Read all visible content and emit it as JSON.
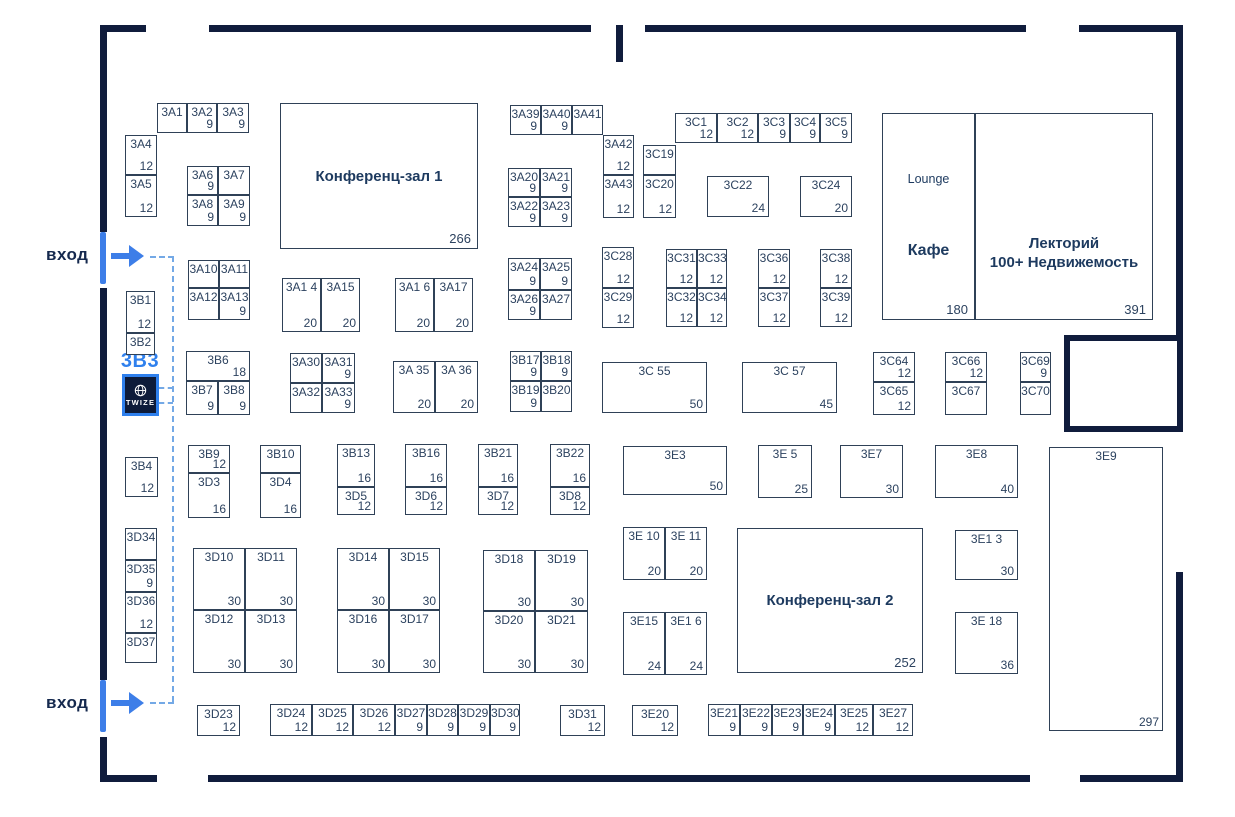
{
  "colors": {
    "wall": "#101c3c",
    "line": "#2f4157",
    "text": "#2c425f",
    "heading": "#1d3a5f",
    "accent": "#2f80ed",
    "route": "#74a9e6",
    "twize_bg": "#0d1b3a"
  },
  "entrances": {
    "top": "вход",
    "bottom": "вход"
  },
  "twize": {
    "booth_id": "3B3",
    "brand": "TWIZE"
  },
  "halls": [
    {
      "label": "Конференц-зал 1",
      "area": "266"
    },
    {
      "label": "Конференц-зал 2",
      "area": "252"
    }
  ],
  "lounge": {
    "zone_label": "Lounge",
    "cafe_label": "Кафе",
    "area": "180"
  },
  "lectory": {
    "line1": "Лекторий",
    "line2": "100+ Недвижемость",
    "area": "391"
  },
  "booths": [
    {
      "id": "3A1",
      "area": "",
      "x": 157,
      "y": 103,
      "w": 30,
      "h": 30
    },
    {
      "id": "3A2",
      "area": "9",
      "x": 187,
      "y": 103,
      "w": 30,
      "h": 30
    },
    {
      "id": "3A3",
      "area": "9",
      "x": 217,
      "y": 103,
      "w": 32,
      "h": 30
    },
    {
      "id": "3A4",
      "area": "12",
      "x": 125,
      "y": 135,
      "w": 32,
      "h": 40
    },
    {
      "id": "3A5",
      "area": "12",
      "x": 125,
      "y": 175,
      "w": 32,
      "h": 42
    },
    {
      "id": "3A6",
      "area": "9",
      "x": 187,
      "y": 166,
      "w": 31,
      "h": 29
    },
    {
      "id": "3A7",
      "area": "",
      "x": 218,
      "y": 166,
      "w": 32,
      "h": 29
    },
    {
      "id": "3A8",
      "area": "9",
      "x": 187,
      "y": 195,
      "w": 31,
      "h": 31
    },
    {
      "id": "3A9",
      "area": "9",
      "x": 218,
      "y": 195,
      "w": 32,
      "h": 31
    },
    {
      "id": "3A10",
      "area": "",
      "x": 188,
      "y": 260,
      "w": 31,
      "h": 28
    },
    {
      "id": "3A11",
      "area": "",
      "x": 219,
      "y": 260,
      "w": 31,
      "h": 28
    },
    {
      "id": "3A12",
      "area": "",
      "x": 188,
      "y": 288,
      "w": 31,
      "h": 32
    },
    {
      "id": "3A13",
      "area": "9",
      "x": 219,
      "y": 288,
      "w": 31,
      "h": 32
    },
    {
      "id": "3A14",
      "label": "3A1 4",
      "area": "20",
      "x": 282,
      "y": 278,
      "w": 39,
      "h": 54
    },
    {
      "id": "3A15",
      "area": "20",
      "x": 321,
      "y": 278,
      "w": 39,
      "h": 54
    },
    {
      "id": "3A16",
      "label": "3A1 6",
      "area": "20",
      "x": 395,
      "y": 278,
      "w": 39,
      "h": 54
    },
    {
      "id": "3A17",
      "area": "20",
      "x": 434,
      "y": 278,
      "w": 39,
      "h": 54
    },
    {
      "id": "3B1",
      "area": "12",
      "x": 126,
      "y": 291,
      "w": 29,
      "h": 42
    },
    {
      "id": "3B2",
      "area": "",
      "x": 126,
      "y": 333,
      "w": 29,
      "h": 22
    },
    {
      "id": "3B4",
      "area": "12",
      "x": 125,
      "y": 457,
      "w": 33,
      "h": 40
    },
    {
      "id": "3B6",
      "area": "18",
      "x": 186,
      "y": 351,
      "w": 64,
      "h": 30
    },
    {
      "id": "3B7",
      "area": "9",
      "x": 186,
      "y": 381,
      "w": 32,
      "h": 34
    },
    {
      "id": "3B8",
      "area": "9",
      "x": 218,
      "y": 381,
      "w": 32,
      "h": 34
    },
    {
      "id": "3A30",
      "area": "",
      "x": 290,
      "y": 353,
      "w": 32,
      "h": 30
    },
    {
      "id": "3A31",
      "area": "9",
      "x": 322,
      "y": 353,
      "w": 33,
      "h": 30
    },
    {
      "id": "3A32",
      "area": "",
      "x": 290,
      "y": 383,
      "w": 32,
      "h": 30
    },
    {
      "id": "3A33",
      "area": "9",
      "x": 322,
      "y": 383,
      "w": 33,
      "h": 30
    },
    {
      "id": "3A35",
      "label": "3A 35",
      "area": "20",
      "x": 393,
      "y": 361,
      "w": 42,
      "h": 52
    },
    {
      "id": "3A36",
      "label": "3A 36",
      "area": "20",
      "x": 435,
      "y": 361,
      "w": 43,
      "h": 52
    },
    {
      "id": "3B17",
      "area": "9",
      "x": 510,
      "y": 351,
      "w": 31,
      "h": 30
    },
    {
      "id": "3B18",
      "area": "9",
      "x": 541,
      "y": 351,
      "w": 31,
      "h": 30
    },
    {
      "id": "3B19",
      "area": "9",
      "x": 510,
      "y": 381,
      "w": 31,
      "h": 31
    },
    {
      "id": "3B20",
      "area": "",
      "x": 541,
      "y": 381,
      "w": 31,
      "h": 31
    },
    {
      "id": "3A39",
      "area": "9",
      "x": 510,
      "y": 105,
      "w": 31,
      "h": 30
    },
    {
      "id": "3A40",
      "area": "9",
      "x": 541,
      "y": 105,
      "w": 31,
      "h": 30
    },
    {
      "id": "3A41",
      "area": "",
      "x": 572,
      "y": 105,
      "w": 31,
      "h": 30
    },
    {
      "id": "3A42",
      "area": "12",
      "x": 603,
      "y": 135,
      "w": 31,
      "h": 40
    },
    {
      "id": "3A43",
      "area": "12",
      "x": 603,
      "y": 175,
      "w": 31,
      "h": 43
    },
    {
      "id": "3C19",
      "area": "",
      "x": 643,
      "y": 145,
      "w": 33,
      "h": 30
    },
    {
      "id": "3C20",
      "area": "12",
      "x": 643,
      "y": 175,
      "w": 33,
      "h": 43
    },
    {
      "id": "3C1",
      "area": "12",
      "x": 675,
      "y": 113,
      "w": 42,
      "h": 30
    },
    {
      "id": "3C2",
      "area": "12",
      "x": 717,
      "y": 113,
      "w": 41,
      "h": 30
    },
    {
      "id": "3C3",
      "area": "9",
      "x": 758,
      "y": 113,
      "w": 32,
      "h": 30
    },
    {
      "id": "3C4",
      "area": "9",
      "x": 790,
      "y": 113,
      "w": 30,
      "h": 30
    },
    {
      "id": "3C5",
      "area": "9",
      "x": 820,
      "y": 113,
      "w": 32,
      "h": 30
    },
    {
      "id": "3C22",
      "area": "24",
      "x": 707,
      "y": 176,
      "w": 62,
      "h": 41
    },
    {
      "id": "3C24",
      "area": "20",
      "x": 800,
      "y": 176,
      "w": 52,
      "h": 41
    },
    {
      "id": "3A20",
      "area": "9",
      "x": 508,
      "y": 168,
      "w": 32,
      "h": 29
    },
    {
      "id": "3A21",
      "area": "9",
      "x": 540,
      "y": 168,
      "w": 32,
      "h": 29
    },
    {
      "id": "3A22",
      "area": "9",
      "x": 508,
      "y": 197,
      "w": 32,
      "h": 30
    },
    {
      "id": "3A23",
      "area": "9",
      "x": 540,
      "y": 197,
      "w": 32,
      "h": 30
    },
    {
      "id": "3A24",
      "area": "9",
      "x": 508,
      "y": 258,
      "w": 32,
      "h": 32
    },
    {
      "id": "3A25",
      "area": "9",
      "x": 540,
      "y": 258,
      "w": 32,
      "h": 32
    },
    {
      "id": "3A26",
      "area": "9",
      "x": 508,
      "y": 290,
      "w": 32,
      "h": 30
    },
    {
      "id": "3A27",
      "area": "",
      "x": 540,
      "y": 290,
      "w": 32,
      "h": 30
    },
    {
      "id": "3C28",
      "area": "12",
      "x": 602,
      "y": 247,
      "w": 32,
      "h": 41
    },
    {
      "id": "3C29",
      "area": "12",
      "x": 602,
      "y": 288,
      "w": 32,
      "h": 40
    },
    {
      "id": "3C31",
      "area": "12",
      "x": 666,
      "y": 249,
      "w": 31,
      "h": 39
    },
    {
      "id": "3C33",
      "area": "12",
      "x": 697,
      "y": 249,
      "w": 30,
      "h": 39
    },
    {
      "id": "3C32",
      "area": "12",
      "x": 666,
      "y": 288,
      "w": 31,
      "h": 39
    },
    {
      "id": "3C34",
      "area": "12",
      "x": 697,
      "y": 288,
      "w": 30,
      "h": 39
    },
    {
      "id": "3C36",
      "area": "12",
      "x": 758,
      "y": 249,
      "w": 32,
      "h": 39
    },
    {
      "id": "3C37",
      "area": "12",
      "x": 758,
      "y": 288,
      "w": 32,
      "h": 39
    },
    {
      "id": "3C38",
      "area": "12",
      "x": 820,
      "y": 249,
      "w": 32,
      "h": 39
    },
    {
      "id": "3C39",
      "area": "12",
      "x": 820,
      "y": 288,
      "w": 32,
      "h": 39
    },
    {
      "id": "3C55",
      "label": "3C 55",
      "area": "50",
      "x": 602,
      "y": 362,
      "w": 105,
      "h": 51
    },
    {
      "id": "3C57",
      "label": "3C 57",
      "area": "45",
      "x": 742,
      "y": 362,
      "w": 95,
      "h": 51
    },
    {
      "id": "3C64",
      "area": "12",
      "x": 873,
      "y": 352,
      "w": 42,
      "h": 30
    },
    {
      "id": "3C65",
      "area": "12",
      "x": 873,
      "y": 382,
      "w": 42,
      "h": 33
    },
    {
      "id": "3C66",
      "area": "12",
      "x": 945,
      "y": 352,
      "w": 42,
      "h": 30
    },
    {
      "id": "3C67",
      "area": "",
      "x": 945,
      "y": 382,
      "w": 42,
      "h": 33
    },
    {
      "id": "3C69",
      "area": "9",
      "x": 1020,
      "y": 352,
      "w": 31,
      "h": 30
    },
    {
      "id": "3C70",
      "area": "",
      "x": 1020,
      "y": 382,
      "w": 31,
      "h": 33
    },
    {
      "id": "3B9",
      "area": "12",
      "x": 188,
      "y": 445,
      "w": 42,
      "h": 28
    },
    {
      "id": "3D3",
      "area": "16",
      "x": 188,
      "y": 473,
      "w": 42,
      "h": 45
    },
    {
      "id": "3B10",
      "area": "",
      "x": 260,
      "y": 445,
      "w": 41,
      "h": 28
    },
    {
      "id": "3D4",
      "area": "16",
      "x": 260,
      "y": 473,
      "w": 41,
      "h": 45
    },
    {
      "id": "3B13",
      "area": "16",
      "x": 337,
      "y": 444,
      "w": 38,
      "h": 43
    },
    {
      "id": "3D5",
      "area": "12",
      "x": 337,
      "y": 487,
      "w": 38,
      "h": 28
    },
    {
      "id": "3B16",
      "area": "16",
      "x": 405,
      "y": 444,
      "w": 42,
      "h": 43
    },
    {
      "id": "3D6",
      "area": "12",
      "x": 405,
      "y": 487,
      "w": 42,
      "h": 28
    },
    {
      "id": "3B21",
      "area": "16",
      "x": 478,
      "y": 444,
      "w": 40,
      "h": 43
    },
    {
      "id": "3D7",
      "area": "12",
      "x": 478,
      "y": 487,
      "w": 40,
      "h": 28
    },
    {
      "id": "3B22",
      "area": "16",
      "x": 550,
      "y": 444,
      "w": 40,
      "h": 43
    },
    {
      "id": "3D8",
      "area": "12",
      "x": 550,
      "y": 487,
      "w": 40,
      "h": 28
    },
    {
      "id": "3E3",
      "area": "50",
      "x": 623,
      "y": 446,
      "w": 104,
      "h": 49
    },
    {
      "id": "3E5",
      "label": "3E 5",
      "area": "25",
      "x": 758,
      "y": 445,
      "w": 54,
      "h": 53
    },
    {
      "id": "3E7",
      "area": "30",
      "x": 840,
      "y": 445,
      "w": 63,
      "h": 53
    },
    {
      "id": "3E8",
      "area": "40",
      "x": 935,
      "y": 445,
      "w": 83,
      "h": 53
    },
    {
      "id": "3E9",
      "area": "297",
      "x": 1049,
      "y": 447,
      "w": 114,
      "h": 284
    },
    {
      "id": "3D34",
      "area": "",
      "x": 125,
      "y": 528,
      "w": 32,
      "h": 32
    },
    {
      "id": "3D35",
      "area": "9",
      "x": 125,
      "y": 560,
      "w": 32,
      "h": 32
    },
    {
      "id": "3D36",
      "area": "12",
      "x": 125,
      "y": 592,
      "w": 32,
      "h": 41
    },
    {
      "id": "3D37",
      "area": "",
      "x": 125,
      "y": 633,
      "w": 32,
      "h": 30
    },
    {
      "id": "3D10",
      "area": "30",
      "x": 193,
      "y": 548,
      "w": 52,
      "h": 62
    },
    {
      "id": "3D11",
      "area": "30",
      "x": 245,
      "y": 548,
      "w": 52,
      "h": 62
    },
    {
      "id": "3D12",
      "area": "30",
      "x": 193,
      "y": 610,
      "w": 52,
      "h": 63
    },
    {
      "id": "3D13",
      "area": "30",
      "x": 245,
      "y": 610,
      "w": 52,
      "h": 63
    },
    {
      "id": "3D14",
      "area": "30",
      "x": 337,
      "y": 548,
      "w": 52,
      "h": 62
    },
    {
      "id": "3D15",
      "area": "30",
      "x": 389,
      "y": 548,
      "w": 51,
      "h": 62
    },
    {
      "id": "3D16",
      "area": "30",
      "x": 337,
      "y": 610,
      "w": 52,
      "h": 63
    },
    {
      "id": "3D17",
      "area": "30",
      "x": 389,
      "y": 610,
      "w": 51,
      "h": 63
    },
    {
      "id": "3D18",
      "area": "30",
      "x": 483,
      "y": 550,
      "w": 52,
      "h": 61
    },
    {
      "id": "3D19",
      "area": "30",
      "x": 535,
      "y": 550,
      "w": 53,
      "h": 61
    },
    {
      "id": "3D20",
      "area": "30",
      "x": 483,
      "y": 611,
      "w": 52,
      "h": 62
    },
    {
      "id": "3D21",
      "area": "30",
      "x": 535,
      "y": 611,
      "w": 53,
      "h": 62
    },
    {
      "id": "3E10",
      "label": "3E 10",
      "area": "20",
      "x": 623,
      "y": 527,
      "w": 42,
      "h": 53
    },
    {
      "id": "3E11",
      "label": "3E 11",
      "area": "20",
      "x": 665,
      "y": 527,
      "w": 42,
      "h": 53
    },
    {
      "id": "3E15",
      "area": "24",
      "x": 623,
      "y": 612,
      "w": 42,
      "h": 63
    },
    {
      "id": "3E16",
      "label": "3E1 6",
      "area": "24",
      "x": 665,
      "y": 612,
      "w": 42,
      "h": 63
    },
    {
      "id": "3E13",
      "label": "3E1 3",
      "area": "30",
      "x": 955,
      "y": 530,
      "w": 63,
      "h": 50
    },
    {
      "id": "3E18",
      "label": "3E 18",
      "area": "36",
      "x": 955,
      "y": 612,
      "w": 63,
      "h": 62
    },
    {
      "id": "3D23",
      "area": "12",
      "x": 197,
      "y": 705,
      "w": 43,
      "h": 31
    },
    {
      "id": "3D24",
      "area": "12",
      "x": 270,
      "y": 704,
      "w": 42,
      "h": 32
    },
    {
      "id": "3D25",
      "area": "12",
      "x": 312,
      "y": 704,
      "w": 41,
      "h": 32
    },
    {
      "id": "3D26",
      "area": "12",
      "x": 353,
      "y": 704,
      "w": 42,
      "h": 32
    },
    {
      "id": "3D27",
      "area": "9",
      "x": 395,
      "y": 704,
      "w": 32,
      "h": 32
    },
    {
      "id": "3D28",
      "area": "9",
      "x": 427,
      "y": 704,
      "w": 31,
      "h": 32
    },
    {
      "id": "3D29",
      "area": "9",
      "x": 458,
      "y": 704,
      "w": 32,
      "h": 32
    },
    {
      "id": "3D30",
      "area": "9",
      "x": 490,
      "y": 704,
      "w": 30,
      "h": 32
    },
    {
      "id": "3D31",
      "area": "12",
      "x": 560,
      "y": 705,
      "w": 45,
      "h": 31
    },
    {
      "id": "3E20",
      "area": "12",
      "x": 632,
      "y": 705,
      "w": 46,
      "h": 31
    },
    {
      "id": "3E21",
      "area": "9",
      "x": 708,
      "y": 704,
      "w": 32,
      "h": 32
    },
    {
      "id": "3E22",
      "area": "9",
      "x": 740,
      "y": 704,
      "w": 32,
      "h": 32
    },
    {
      "id": "3E23",
      "area": "9",
      "x": 772,
      "y": 704,
      "w": 31,
      "h": 32
    },
    {
      "id": "3E24",
      "area": "9",
      "x": 803,
      "y": 704,
      "w": 32,
      "h": 32
    },
    {
      "id": "3E25",
      "area": "12",
      "x": 835,
      "y": 704,
      "w": 38,
      "h": 32
    },
    {
      "id": "3E27",
      "area": "12",
      "x": 873,
      "y": 704,
      "w": 40,
      "h": 32
    }
  ]
}
